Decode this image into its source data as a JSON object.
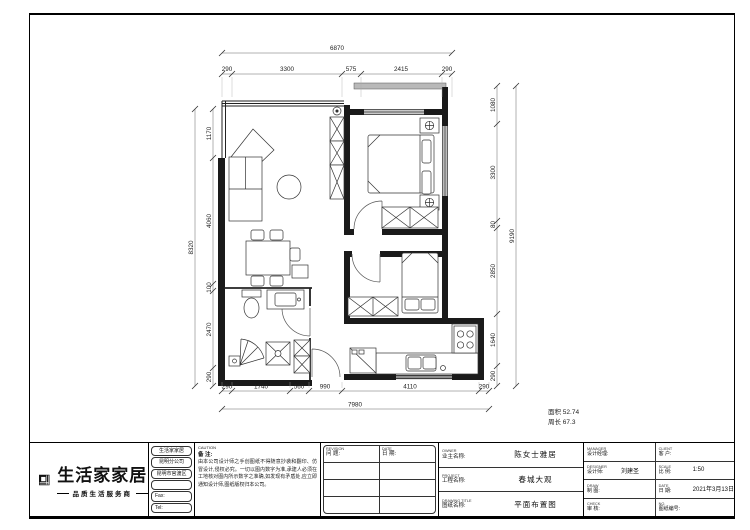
{
  "sheet": {
    "area_note": {
      "line1": "面积 52.74",
      "line2": "周长 67.3"
    }
  },
  "dims": {
    "top": {
      "overall": "6870",
      "segments": [
        "290",
        "3300",
        "575",
        "2415",
        "290"
      ]
    },
    "bottom": {
      "overall": "7980",
      "segments": [
        "290",
        "1740",
        "560",
        "990",
        "4110",
        "290"
      ]
    },
    "left": {
      "overall": "8320",
      "segments": [
        "1170",
        "4060",
        "100",
        "2470",
        "290"
      ]
    },
    "right": {
      "overall": "9190",
      "segments": [
        "1080",
        "3300",
        "80",
        "2850",
        "1640",
        "290"
      ]
    }
  },
  "titleblock": {
    "logo": {
      "company": "生活家家居",
      "tagline": "品质生活服务商"
    },
    "address": [
      "生活家家居",
      "昆明分公司",
      "昆明市官渡区",
      "",
      "Fax:",
      "Tel:"
    ],
    "caution": {
      "en": "CAUTION",
      "cn": "备 注:",
      "body": "由本公司设计师之手创图纸不得随意抄袭和翻印、仿冒设计,侵权必究。一切以图内数字为准,承建人必须在工地核对图内所示数字之准确,如发现有矛盾处,应立即通知设计师,图纸版权归本公司。"
    },
    "revision": {
      "col1_en": "REVISION",
      "col1_cn": "问 题:",
      "col2_en": "DATE",
      "col2_cn": "日 期:"
    },
    "project": [
      {
        "en": "OWNER",
        "cn": "业主名称:",
        "value": "陈女士雅居"
      },
      {
        "en": "PROJECT",
        "cn": "工程名称:",
        "value": "春城大观"
      },
      {
        "en": "DRAWING TITLE",
        "cn": "图纸名称:",
        "value": "平面布置图"
      }
    ],
    "personnel": {
      "left": [
        {
          "en": "MANAGER",
          "cn": "设计经理:",
          "value": ""
        },
        {
          "en": "DESIGNER",
          "cn": "设计师:",
          "value": "刘建圣"
        },
        {
          "en": "DRAW",
          "cn": "制 图:",
          "value": ""
        },
        {
          "en": "CHECK",
          "cn": "审 核:",
          "value": ""
        }
      ],
      "right": [
        {
          "en": "CLIENT",
          "cn": "客 户:",
          "value": ""
        },
        {
          "en": "SCALE",
          "cn": "比 例:",
          "value": "1:50"
        },
        {
          "en": "DATE",
          "cn": "日 期:",
          "value": "2021年3月13日"
        },
        {
          "en": "NO.",
          "cn": "图纸编号:",
          "value": ""
        }
      ]
    }
  }
}
